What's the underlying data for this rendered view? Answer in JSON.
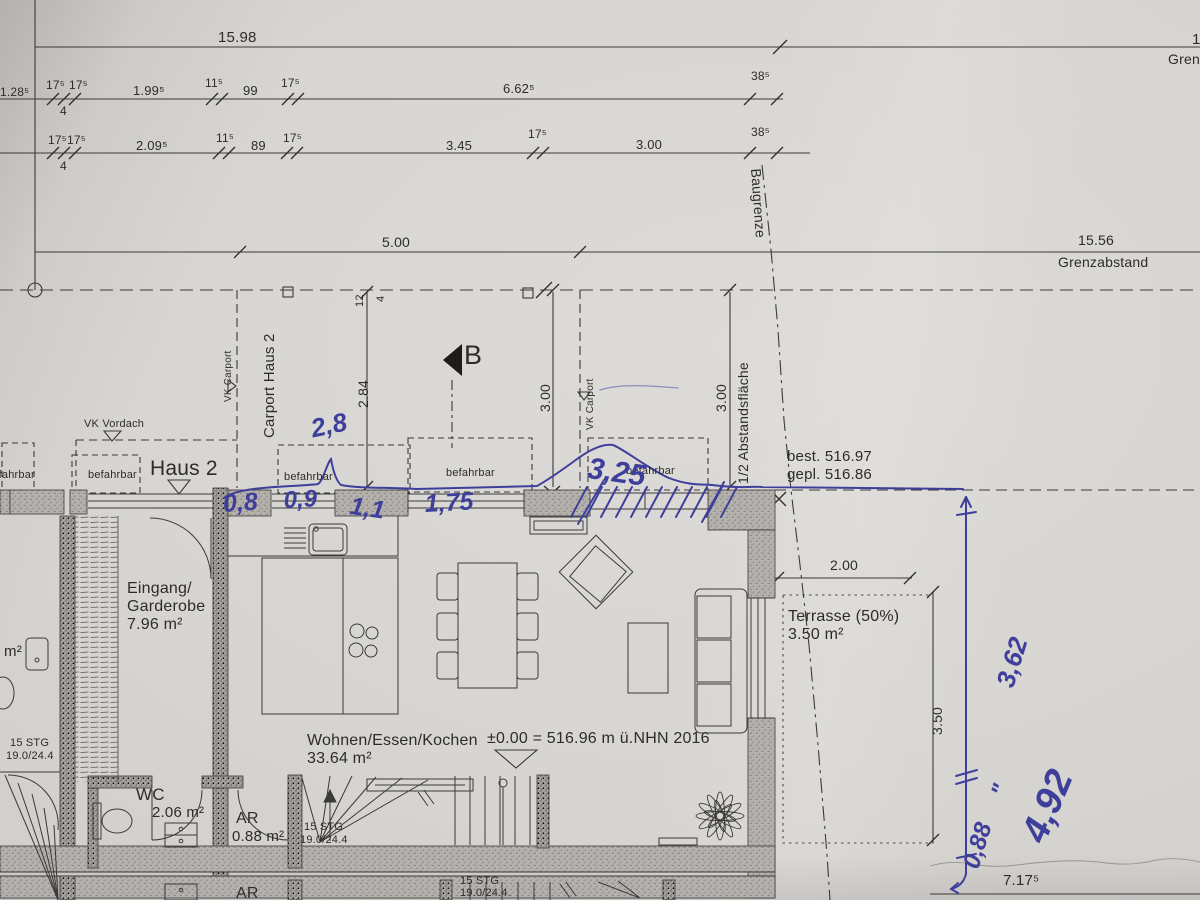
{
  "dims": {
    "overall_top": "15.98",
    "right_partial_num": "1",
    "right_partial_label": "Gren",
    "row1": {
      "d1": "1.28⁵",
      "d2": "17⁵",
      "d3": "17⁵",
      "d4": "1.99⁵",
      "d5": "11⁵",
      "d6": "99",
      "d7": "17⁵",
      "d8": "6.62⁵",
      "d9": "38⁵",
      "d10": "4"
    },
    "row2": {
      "d1": "17⁵",
      "d2": "17⁵",
      "d3": "2.09⁵",
      "d4": "11⁵",
      "d5": "89",
      "d6": "17⁵",
      "d7": "3.45",
      "d8": "17⁵",
      "d9": "3.00",
      "d10": "38⁵",
      "d11": "4"
    },
    "r500": "5.00",
    "r1556": "15.56",
    "grenzabstand": "Grenzabstand",
    "v12": "12",
    "v4": "4",
    "v284": "2.84",
    "v300l": "3.00",
    "v300r": "3.00",
    "t200": "2.00",
    "t350": "3.50",
    "b717": "7.17⁵"
  },
  "labels": {
    "baugrenze": "Baugrenze",
    "abstand": "1/2 Abstandsfläche",
    "vk_carport_l": "VK Carport",
    "vk_carport_r": "VK Carport",
    "carport_haus2": "Carport Haus 2",
    "vk_vordach": "VK Vordach",
    "haus2": "Haus 2",
    "befahrbar1": "befahrbar",
    "befahrbar2": "befahrbar",
    "befahrbar3": "befahrbar",
    "befahrbar4": "befahrbar",
    "befahrbar5": "befahrbar",
    "best": "best. 516.97",
    "gepl": "gepl. 516.86",
    "section_b": "B",
    "level": "±0.00 = 516.96 m ü.NHN 2016"
  },
  "rooms": {
    "eingang1": "Eingang/",
    "eingang2": "Garderobe",
    "eingang_area": "7.96 m²",
    "wohnen": "Wohnen/Essen/Kochen",
    "wohnen_area": "33.64 m²",
    "wc": "WC",
    "wc_area": "2.06 m²",
    "ar": "AR",
    "ar_area": "0.88 m²",
    "ar_lower": "AR",
    "m2_partial": "m²",
    "terrasse": "Terrasse (50%)",
    "terrasse_area": "3.50 m²"
  },
  "stairs": {
    "stg1": "15 STG",
    "riser1": "19.0/24.4",
    "stg2": "15 STG",
    "riser2": "19.0/24.4.",
    "stg3": "15 STG",
    "riser3": "19.0/24.4"
  },
  "handwriting": {
    "h28": "2,8",
    "h08": "0,8",
    "h09": "0,9",
    "h11": "1,1",
    "h175": "1,75",
    "h325": "3,25",
    "h362": "3,62",
    "h492": "4,92",
    "h088": "0,88",
    "ditto": "\""
  },
  "colors": {
    "pen": "#3e3f9b",
    "ink": "#2d2c2a",
    "paper": "#d7d5d2"
  }
}
